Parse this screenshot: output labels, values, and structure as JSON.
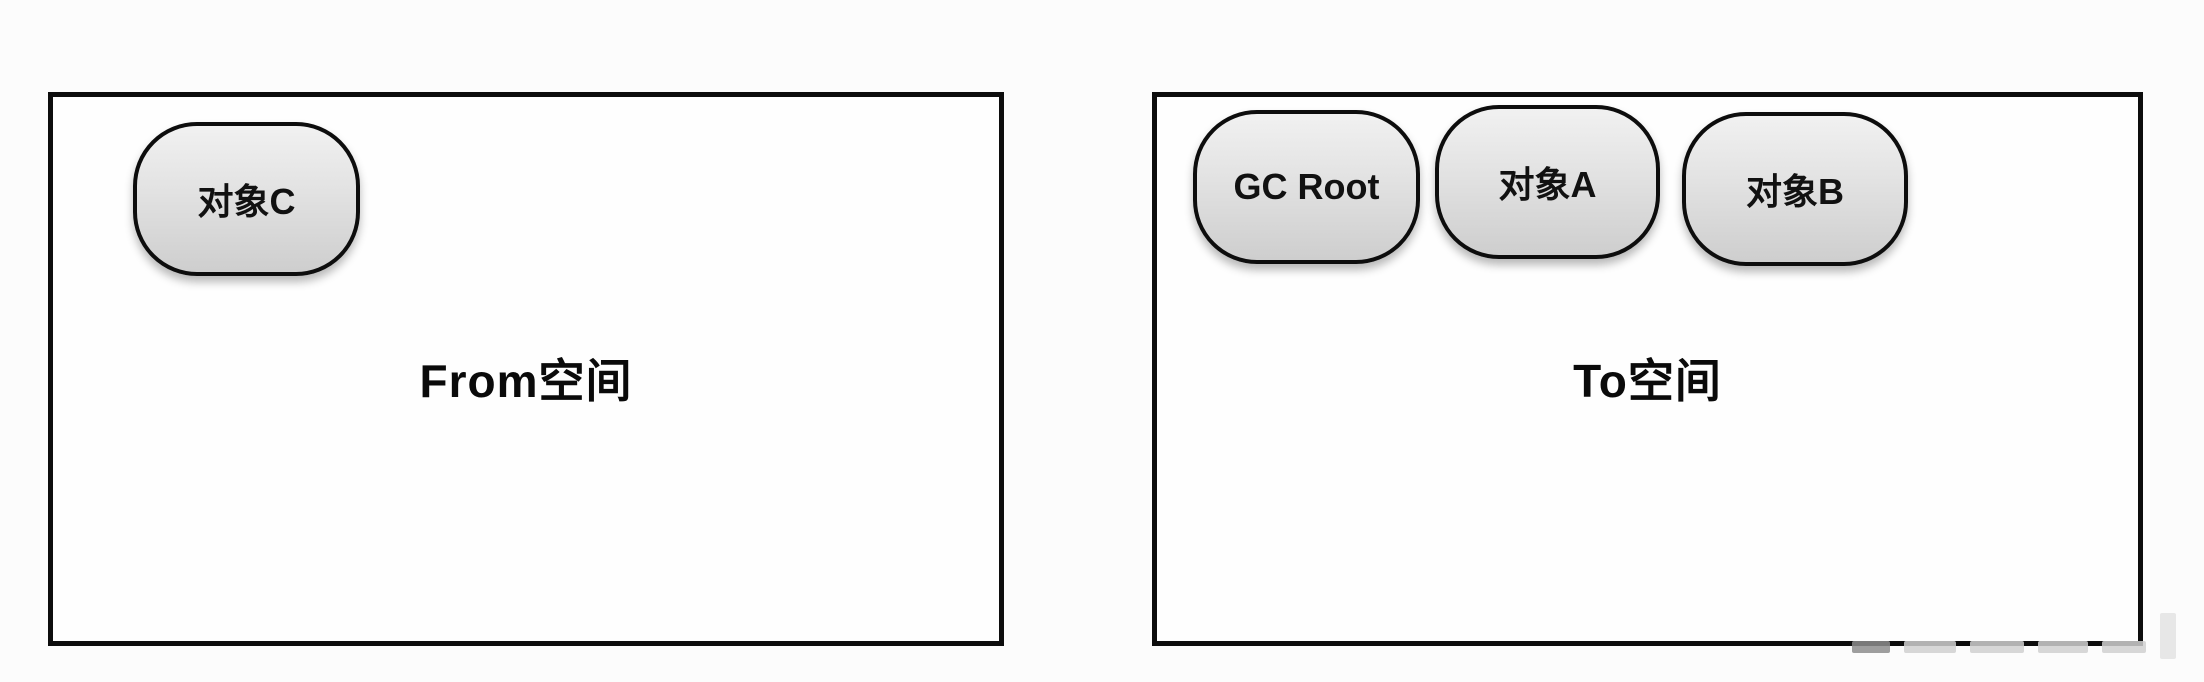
{
  "diagram": {
    "background_color": "#fcfcfc",
    "line_color": "#0d0d0d",
    "node_fill_top": "#f1f1f1",
    "node_fill_bottom": "#cecece",
    "spaces": [
      {
        "label": "From空间",
        "nodes": [
          {
            "label": "对象C"
          }
        ]
      },
      {
        "label": "To空间",
        "nodes": [
          {
            "label": "GC Root"
          },
          {
            "label": "对象A"
          },
          {
            "label": "对象B"
          }
        ]
      }
    ]
  }
}
